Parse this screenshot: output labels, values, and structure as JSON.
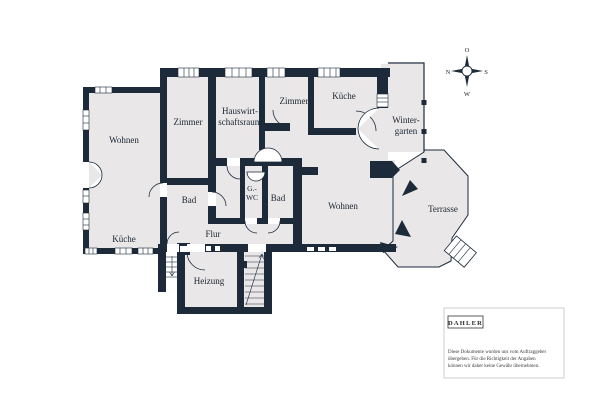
{
  "rooms": {
    "wohnen_left": "Wohnen",
    "kueche_left": "Küche",
    "zimmer_left": "Zimmer",
    "hauswirtschaftsraum": [
      "Hauswirt-",
      "schaftsraum"
    ],
    "zimmer_top": "Zimmer",
    "kueche_top": "Küche",
    "wintergarten": [
      "Winter-",
      "garten"
    ],
    "bad_left": "Bad",
    "gwc": [
      "G.-",
      "WC"
    ],
    "bad_mid": "Bad",
    "wohnen_right": "Wohnen",
    "terrasse": "Terrasse",
    "flur": "Flur",
    "heizung": "Heizung"
  },
  "compass": {
    "top": "O",
    "left": "N",
    "right": "S",
    "bottom": "W"
  },
  "branding": {
    "logo": "DAHLER",
    "disclaimer": [
      "Diese Dokumente wurden uns vom Auftraggeber",
      "übergeben. Für die Richtigkeit der Angaben",
      "können wir daher keine Gewähr übernehmen."
    ]
  },
  "colors": {
    "wall": "#1c2a3a",
    "room_fill": "#e9e7e8",
    "background": "#ffffff",
    "card_border": "#cccccc"
  }
}
